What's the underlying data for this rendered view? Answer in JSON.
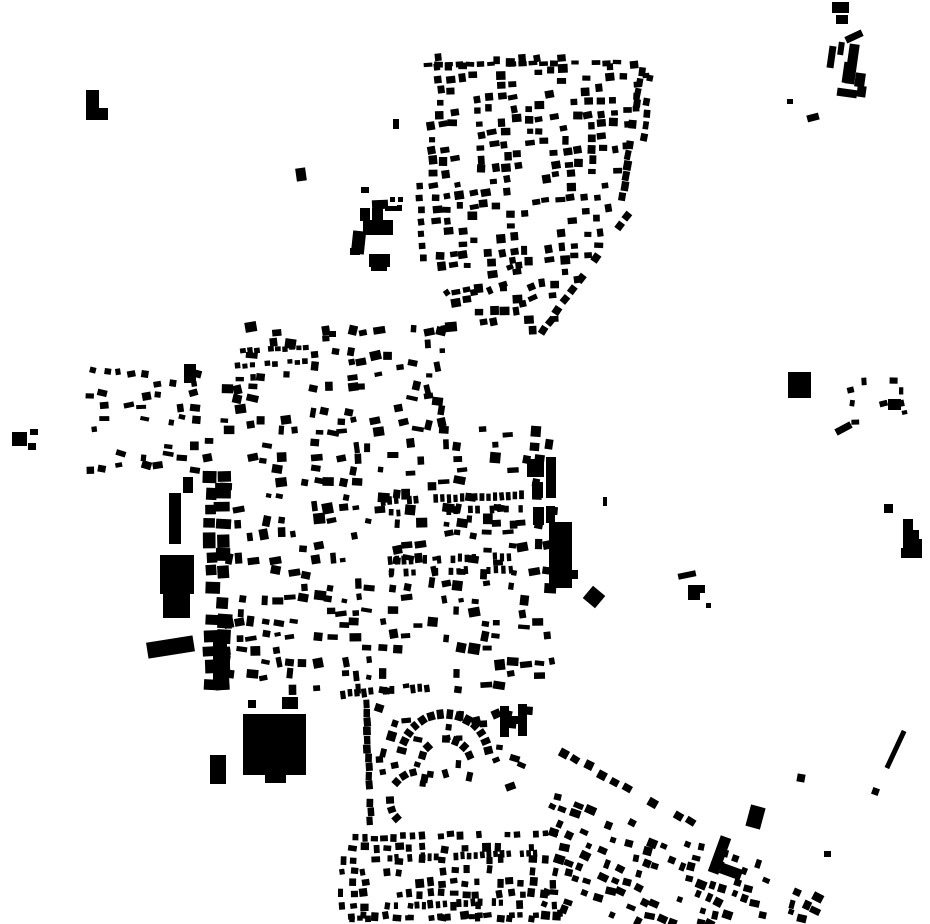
{
  "figure": {
    "kind": "figure-ground-building-map",
    "width": 930,
    "height": 924
  },
  "colors": {
    "background": "#ffffff",
    "building": "#000000"
  },
  "map": {
    "buildings": [
      [
        86,
        90,
        13,
        28,
        0
      ],
      [
        86,
        108,
        22,
        12,
        0
      ],
      [
        296,
        168,
        10,
        13,
        -8
      ],
      [
        393,
        119,
        6,
        10,
        0
      ],
      [
        361,
        187,
        8,
        6,
        0
      ],
      [
        329,
        331,
        7,
        6,
        0
      ],
      [
        372,
        200,
        16,
        9,
        -3
      ],
      [
        360,
        208,
        10,
        13,
        0
      ],
      [
        372,
        208,
        11,
        13,
        0
      ],
      [
        385,
        206,
        17,
        5,
        0
      ],
      [
        390,
        197,
        5,
        5,
        0
      ],
      [
        398,
        197,
        5,
        5,
        0
      ],
      [
        397,
        205,
        5,
        4,
        0
      ],
      [
        363,
        220,
        30,
        15,
        0
      ],
      [
        352,
        231,
        13,
        23,
        6
      ],
      [
        350,
        248,
        10,
        7,
        0
      ],
      [
        369,
        254,
        21,
        13,
        0
      ],
      [
        371,
        265,
        16,
        6,
        0
      ],
      [
        832,
        2,
        17,
        11,
        0
      ],
      [
        836,
        15,
        12,
        9,
        0
      ],
      [
        845,
        33,
        18,
        7,
        -25
      ],
      [
        828,
        46,
        7,
        22,
        8
      ],
      [
        838,
        42,
        6,
        13,
        8
      ],
      [
        847,
        44,
        10,
        40,
        8
      ],
      [
        843,
        62,
        7,
        21,
        8
      ],
      [
        855,
        73,
        10,
        14,
        8
      ],
      [
        837,
        89,
        20,
        8,
        8
      ],
      [
        857,
        86,
        9,
        11,
        8
      ],
      [
        787,
        99,
        6,
        5,
        0
      ],
      [
        807,
        114,
        12,
        7,
        -15
      ],
      [
        788,
        372,
        12,
        26,
        0
      ],
      [
        800,
        372,
        11,
        26,
        0
      ],
      [
        888,
        399,
        13,
        11,
        0
      ],
      [
        835,
        425,
        17,
        7,
        -28
      ],
      [
        884,
        504,
        9,
        9,
        0
      ],
      [
        903,
        519,
        10,
        12,
        0
      ],
      [
        903,
        530,
        16,
        10,
        0
      ],
      [
        903,
        539,
        19,
        9,
        0
      ],
      [
        901,
        548,
        21,
        10,
        0
      ],
      [
        603,
        497,
        4,
        9,
        0
      ],
      [
        586,
        589,
        16,
        16,
        40
      ],
      [
        678,
        572,
        18,
        6,
        -12
      ],
      [
        688,
        585,
        12,
        15,
        0
      ],
      [
        698,
        585,
        7,
        8,
        0
      ],
      [
        706,
        603,
        5,
        5,
        0
      ],
      [
        527,
        459,
        17,
        18,
        0
      ],
      [
        546,
        457,
        10,
        41,
        0
      ],
      [
        532,
        482,
        11,
        16,
        0
      ],
      [
        533,
        507,
        11,
        18,
        0
      ],
      [
        546,
        506,
        9,
        17,
        0
      ],
      [
        549,
        522,
        23,
        66,
        0
      ],
      [
        568,
        570,
        10,
        9,
        0
      ],
      [
        169,
        493,
        12,
        51,
        0
      ],
      [
        183,
        477,
        10,
        16,
        0
      ],
      [
        160,
        555,
        34,
        39,
        0
      ],
      [
        163,
        594,
        27,
        24,
        0
      ],
      [
        147,
        639,
        47,
        16,
        -9
      ],
      [
        213,
        640,
        14,
        46,
        0
      ],
      [
        184,
        364,
        12,
        19,
        0
      ],
      [
        243,
        714,
        63,
        61,
        0
      ],
      [
        265,
        772,
        21,
        11,
        0
      ],
      [
        210,
        755,
        16,
        29,
        0
      ],
      [
        282,
        697,
        16,
        12,
        0
      ],
      [
        248,
        700,
        8,
        8,
        0
      ],
      [
        500,
        706,
        9,
        31,
        0
      ],
      [
        518,
        704,
        9,
        32,
        0
      ],
      [
        506,
        716,
        14,
        8,
        0
      ],
      [
        12,
        432,
        15,
        14,
        0
      ],
      [
        30,
        429,
        8,
        6,
        0
      ],
      [
        28,
        443,
        8,
        7,
        0
      ],
      [
        748,
        806,
        15,
        22,
        15
      ],
      [
        797,
        774,
        8,
        8,
        10
      ],
      [
        872,
        788,
        7,
        7,
        20
      ],
      [
        893,
        729,
        5,
        41,
        25
      ],
      [
        714,
        836,
        11,
        38,
        20
      ],
      [
        720,
        866,
        22,
        11,
        20
      ],
      [
        824,
        851,
        7,
        6,
        0
      ]
    ],
    "grids": [
      {
        "name": "north-district",
        "origin": [
          424,
          56
        ],
        "rot": -4.5,
        "nx": 19,
        "dx": 12.3,
        "ny": 25,
        "dy": 11.8,
        "fill": 0.56,
        "bw": [
          6,
          10
        ],
        "bh": [
          5,
          9
        ],
        "jitter": 2.2,
        "rotJitter": 7,
        "seed": 11,
        "clip": [
          [
            424,
            56
          ],
          [
            650,
            56
          ],
          [
            639,
            130
          ],
          [
            613,
            222
          ],
          [
            547,
            348
          ],
          [
            504,
            334
          ],
          [
            444,
            306
          ],
          [
            425,
            168
          ]
        ]
      },
      {
        "name": "west-hamlet",
        "origin": [
          92,
          372
        ],
        "rot": 0,
        "nx": 10,
        "dx": 13,
        "ny": 9,
        "dy": 12,
        "fill": 0.36,
        "bw": [
          5,
          11
        ],
        "bh": [
          4,
          9
        ],
        "jitter": 3.5,
        "rotJitter": 18,
        "seed": 22
      },
      {
        "name": "oldtown-northwest",
        "origin": [
          225,
          330
        ],
        "rot": 0,
        "nx": 19,
        "dx": 12.6,
        "ny": 9,
        "dy": 11.5,
        "fill": 0.4,
        "bw": [
          5,
          12
        ],
        "bh": [
          4,
          10
        ],
        "jitter": 3.2,
        "rotJitter": 14,
        "seed": 33
      },
      {
        "name": "oldtown-core",
        "origin": [
          227,
          432
        ],
        "rot": 0,
        "nx": 26,
        "dx": 12.9,
        "ny": 21,
        "dy": 12.8,
        "fill": 0.42,
        "bw": [
          5,
          12
        ],
        "bh": [
          4,
          11
        ],
        "jitter": 3.2,
        "rotJitter": 12,
        "seed": 44
      },
      {
        "name": "district-junction",
        "origin": [
          435,
          296
        ],
        "rot": -20,
        "nx": 8,
        "dx": 13,
        "ny": 4,
        "dy": 12,
        "fill": 0.38,
        "bw": [
          5,
          10
        ],
        "bh": [
          5,
          9
        ],
        "jitter": 3,
        "rotJitter": 15,
        "seed": 55
      },
      {
        "name": "south-suburb-fill",
        "origin": [
          382,
          712
        ],
        "rot": 0,
        "nx": 12,
        "dx": 13,
        "ny": 7,
        "dy": 12.5,
        "fill": 0.28,
        "bw": [
          5,
          10
        ],
        "bh": [
          5,
          10
        ],
        "jitter": 4,
        "rotJitter": 25,
        "seed": 66
      },
      {
        "name": "south-grid",
        "origin": [
          342,
          848
        ],
        "rot": 0,
        "nx": 20,
        "dx": 11.2,
        "ny": 7,
        "dy": 11.5,
        "fill": 0.55,
        "bw": [
          5,
          9
        ],
        "bh": [
          5,
          9
        ],
        "jitter": 2,
        "rotJitter": 10,
        "seed": 77
      },
      {
        "name": "southeast-arm",
        "origin": [
          556,
          796
        ],
        "rot": 19,
        "nx": 25,
        "dx": 11.8,
        "ny": 10,
        "dy": 11.8,
        "fill": 0.5,
        "bw": [
          5,
          11
        ],
        "bh": [
          5,
          9
        ],
        "jitter": 2.5,
        "rotJitter": 9,
        "seed": 88,
        "clip": [
          [
            548,
            790
          ],
          [
            705,
            840
          ],
          [
            818,
            866
          ],
          [
            822,
            924
          ],
          [
            543,
            924
          ]
        ]
      },
      {
        "name": "east-dots",
        "origin": [
          853,
          382
        ],
        "rot": 0,
        "nx": 6,
        "dx": 10,
        "ny": 5,
        "dy": 10,
        "fill": 0.45,
        "bw": [
          4,
          8
        ],
        "bh": [
          4,
          9
        ],
        "jitter": 2.5,
        "rotJitter": 15,
        "seed": 99
      },
      {
        "name": "industrial-column",
        "origin": [
          211,
          476
        ],
        "rot": 0,
        "nx": 2,
        "dx": 12,
        "ny": 14,
        "dy": 16,
        "fill": 0.85,
        "bw": [
          10,
          16
        ],
        "bh": [
          9,
          17
        ],
        "jitter": 2,
        "rotJitter": 4,
        "seed": 101
      }
    ],
    "rows": [
      {
        "name": "district-top-row",
        "from": [
          428,
          65
        ],
        "to": [
          642,
          62
        ],
        "sp": 10.5,
        "fill": 0.86,
        "bw": [
          7,
          9
        ],
        "bh": [
          4,
          6
        ],
        "jitter": 1,
        "seed": 201
      },
      {
        "name": "district-right-edge",
        "from": [
          641,
          72
        ],
        "to": [
          621,
          212
        ],
        "sp": 10.5,
        "fill": 0.85,
        "bw": [
          8,
          10
        ],
        "bh": [
          6,
          8
        ],
        "jitter": 1.5,
        "seed": 202
      },
      {
        "name": "district-right-edge2",
        "from": [
          651,
          78
        ],
        "to": [
          634,
          200
        ],
        "sp": 12,
        "fill": 0.5,
        "bw": [
          6,
          8
        ],
        "bh": [
          5,
          7
        ],
        "jitter": 2,
        "seed": 203
      },
      {
        "name": "district-se-edge",
        "from": [
          627,
          216
        ],
        "to": [
          530,
          348
        ],
        "sp": 13,
        "fill": 0.8,
        "bw": [
          8,
          9
        ],
        "bh": [
          7,
          8
        ],
        "jitter": 1.5,
        "seed": 204
      },
      {
        "name": "west-column",
        "from": [
          419,
          186
        ],
        "to": [
          425,
          272
        ],
        "sp": 12,
        "fill": 0.7,
        "bw": [
          6,
          7
        ],
        "bh": [
          6,
          7
        ],
        "jitter": 1.5,
        "seed": 205
      },
      {
        "name": "oldtown-dash-row1",
        "from": [
          229,
          352
        ],
        "to": [
          312,
          347
        ],
        "sp": 7,
        "fill": 0.9,
        "bw": [
          5,
          6
        ],
        "bh": [
          4,
          6
        ],
        "jitter": 0.8,
        "seed": 206
      },
      {
        "name": "oldtown-dash-row2",
        "from": [
          230,
          366
        ],
        "to": [
          310,
          361
        ],
        "sp": 7.5,
        "fill": 0.7,
        "bw": [
          5,
          6
        ],
        "bh": [
          4,
          6
        ],
        "jitter": 1,
        "seed": 207
      },
      {
        "name": "terrace-row1",
        "from": [
          383,
          501
        ],
        "to": [
          524,
          495
        ],
        "sp": 6.6,
        "fill": 0.88,
        "bw": [
          4,
          5
        ],
        "bh": [
          7,
          9
        ],
        "jitter": 0.8,
        "seed": 208
      },
      {
        "name": "terrace-row2",
        "from": [
          384,
          513
        ],
        "to": [
          524,
          508
        ],
        "sp": 7.2,
        "fill": 0.72,
        "bw": [
          4,
          5
        ],
        "bh": [
          6,
          8
        ],
        "jitter": 1,
        "seed": 209
      },
      {
        "name": "terrace-row3",
        "from": [
          390,
          561
        ],
        "to": [
          521,
          556
        ],
        "sp": 7,
        "fill": 0.8,
        "bw": [
          4,
          5
        ],
        "bh": [
          7,
          9
        ],
        "jitter": 0.9,
        "seed": 210
      },
      {
        "name": "terrace-row4",
        "from": [
          391,
          574
        ],
        "to": [
          521,
          569
        ],
        "sp": 7.5,
        "fill": 0.65,
        "bw": [
          4,
          5
        ],
        "bh": [
          6,
          8
        ],
        "jitter": 1.2,
        "seed": 211
      },
      {
        "name": "suburb-top-row",
        "from": [
          343,
          694
        ],
        "to": [
          428,
          688
        ],
        "sp": 7,
        "fill": 0.85,
        "bw": [
          4,
          6
        ],
        "bh": [
          7,
          9
        ],
        "jitter": 1,
        "seed": 212
      },
      {
        "name": "suburb-west-wall",
        "from": [
          366,
          704
        ],
        "to": [
          371,
          836
        ],
        "sp": 9,
        "fill": 0.92,
        "bw": [
          8,
          9
        ],
        "bh": [
          6,
          8
        ],
        "jitter": 1,
        "seed": 213
      },
      {
        "name": "suburb-mid-row",
        "from": [
          346,
          838
        ],
        "to": [
          562,
          832
        ],
        "sp": 9.5,
        "fill": 0.75,
        "bw": [
          5,
          8
        ],
        "bh": [
          5,
          8
        ],
        "jitter": 1.5,
        "seed": 214
      },
      {
        "name": "bottom-dash-row1",
        "from": [
          390,
          858
        ],
        "to": [
          540,
          853
        ],
        "sp": 6.6,
        "fill": 0.8,
        "bw": [
          4,
          5
        ],
        "bh": [
          6,
          8
        ],
        "jitter": 0.8,
        "seed": 215
      },
      {
        "name": "bottom-dash-row2",
        "from": [
          396,
          906
        ],
        "to": [
          520,
          901
        ],
        "sp": 7,
        "fill": 0.7,
        "bw": [
          4,
          5
        ],
        "bh": [
          6,
          8
        ],
        "jitter": 1,
        "seed": 216
      },
      {
        "name": "bottom-dash-row3",
        "from": [
          352,
          919
        ],
        "to": [
          560,
          914
        ],
        "sp": 8,
        "fill": 0.6,
        "bw": [
          5,
          6
        ],
        "bh": [
          5,
          7
        ],
        "jitter": 1,
        "seed": 217
      },
      {
        "name": "arm-diagonal-row",
        "from": [
          563,
          753
        ],
        "to": [
          700,
          827
        ],
        "sp": 14.5,
        "fill": 0.78,
        "bw": [
          8,
          10
        ],
        "bh": [
          7,
          9
        ],
        "jitter": 2,
        "seed": 218
      }
    ],
    "arcs": [
      {
        "name": "crescent-outer",
        "c": [
          445,
          758
        ],
        "r": 44,
        "a0": -170,
        "a1": -10,
        "sp": 9,
        "fill": 0.95,
        "bw": [
          6,
          8
        ],
        "bh": [
          8,
          10
        ],
        "seed": 301
      },
      {
        "name": "crescent-inner",
        "c": [
          446,
          764
        ],
        "r": 25,
        "a0": -160,
        "a1": -20,
        "sp": 9,
        "fill": 0.9,
        "bw": [
          6,
          8
        ],
        "bh": [
          7,
          9
        ],
        "seed": 302
      },
      {
        "name": "crescent-southwest",
        "c": [
          418,
          800
        ],
        "r": 28,
        "a0": 120,
        "a1": 260,
        "sp": 9.5,
        "fill": 0.9,
        "bw": [
          6,
          8
        ],
        "bh": [
          7,
          9
        ],
        "seed": 303
      }
    ]
  }
}
